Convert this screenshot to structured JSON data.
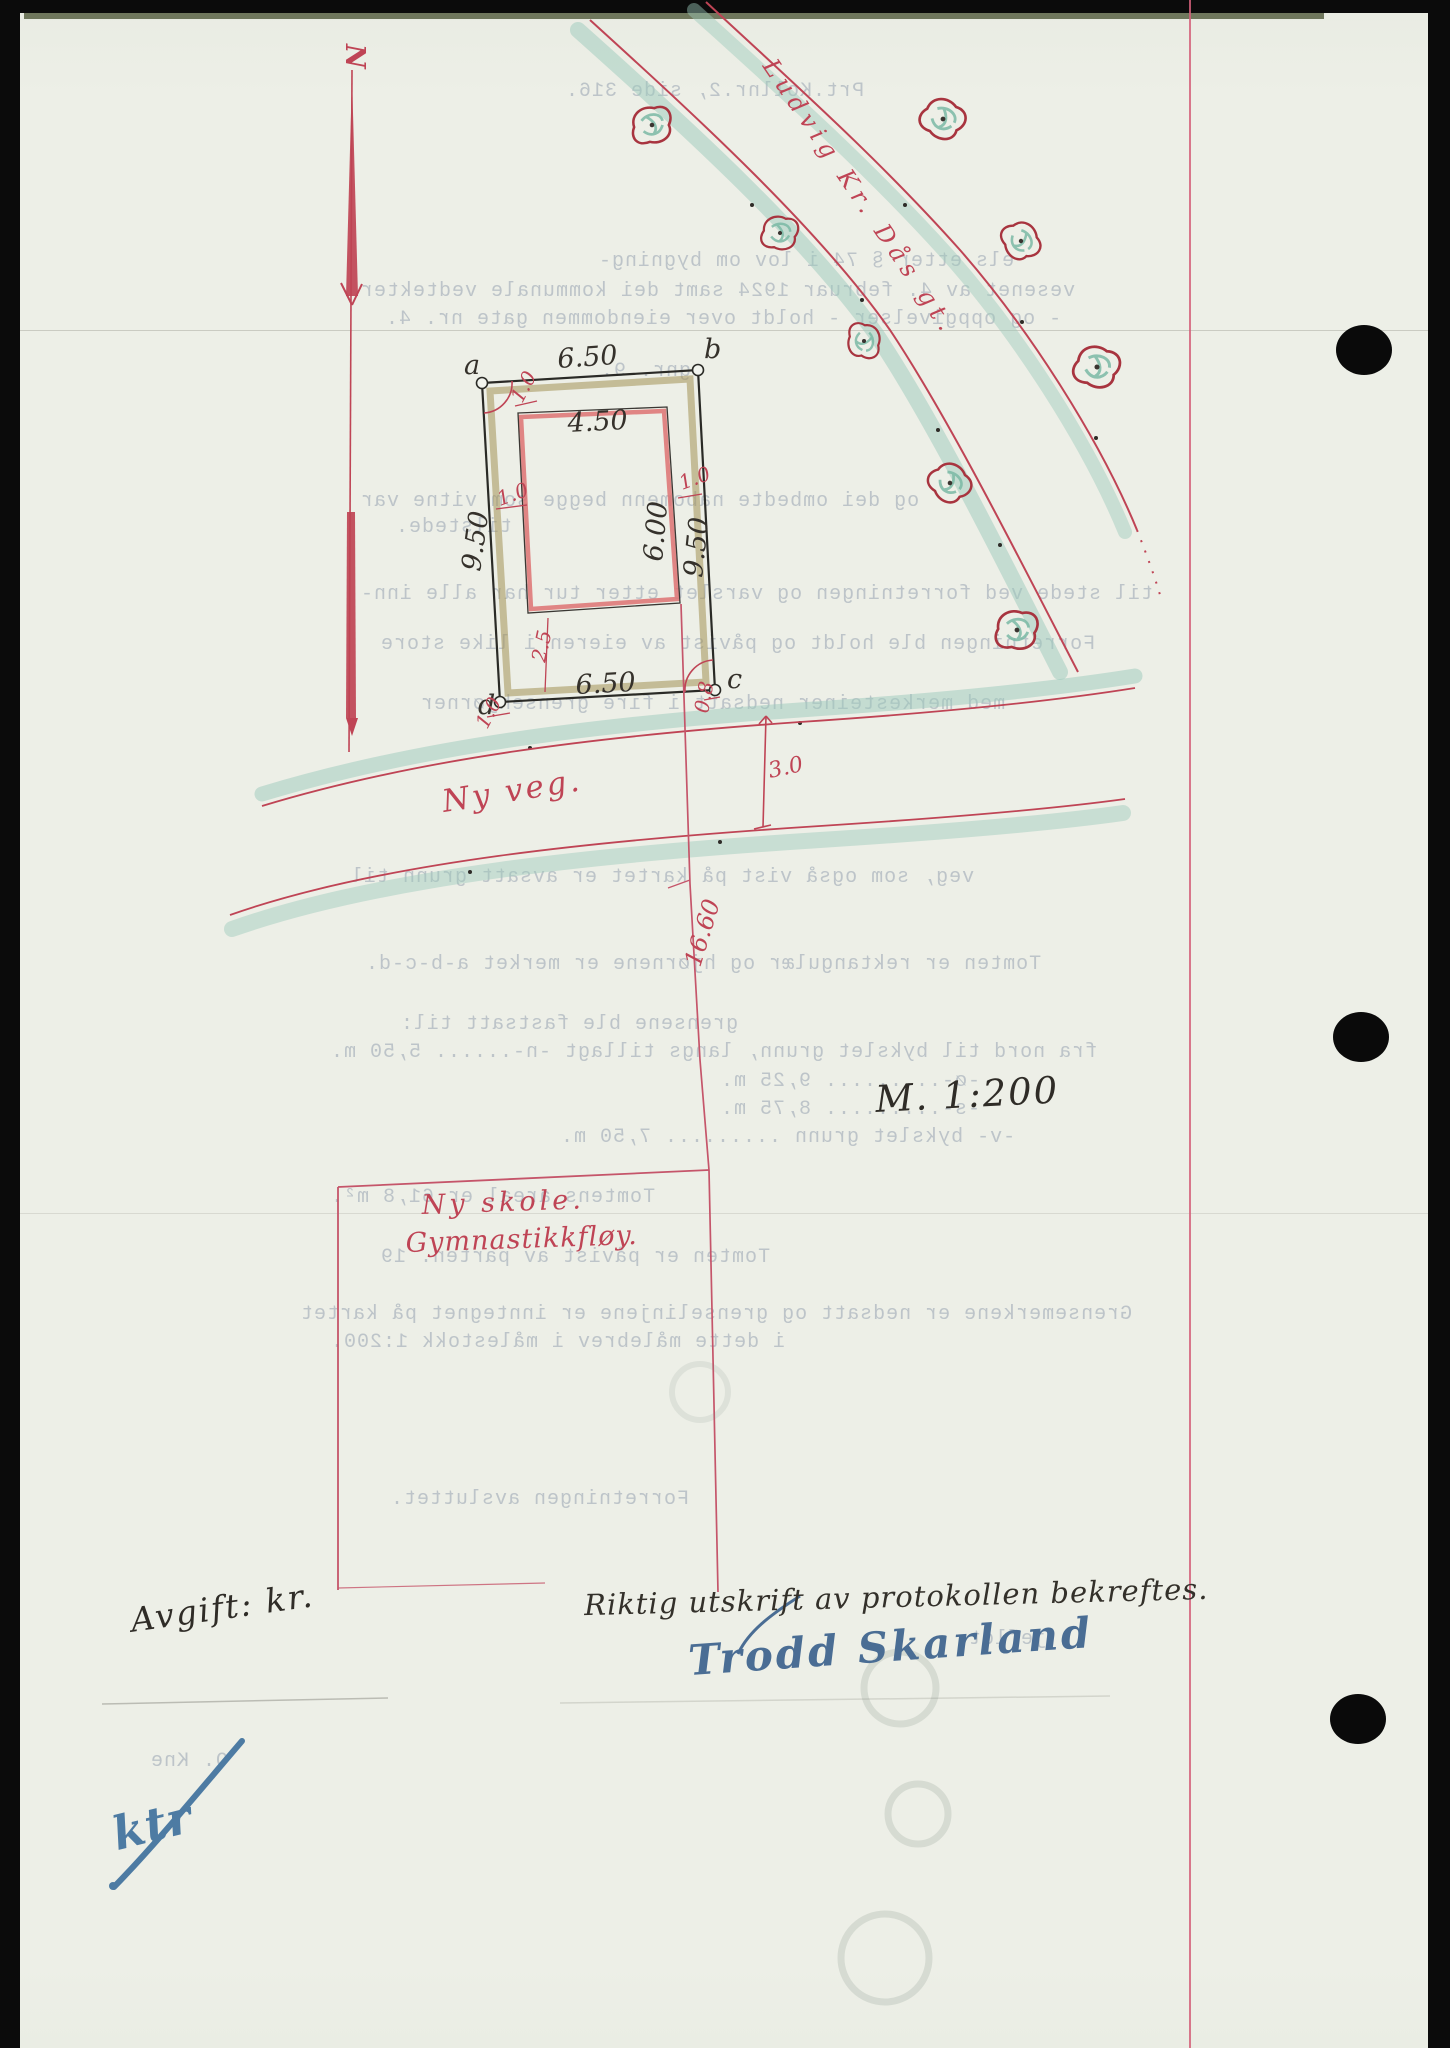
{
  "map": {
    "north_label": "N",
    "street_name": "Ludvig Kr. Dås gt.",
    "road_label": "Ny veg.",
    "school_line1": "Ny skole.",
    "school_line2": "Gymnastikkfløy.",
    "scale_label": "M. 1:200",
    "corners": {
      "a": "a",
      "b": "b",
      "c": "c",
      "d": "d"
    },
    "dims": {
      "top": "6.50",
      "bottom": "6.50",
      "left": "9.50",
      "right": "9.50",
      "inner_top": "4.50",
      "inner_right": "6.00",
      "bottom_gap": "2.5",
      "off_tl": "1.0",
      "off_left": "1.0",
      "off_right": "1.0",
      "off_bl": "1.0",
      "off_c": "0.8",
      "road_width": "3.0",
      "distance_line": "16.60"
    }
  },
  "footer": {
    "fee_label": "Avgift: kr.",
    "certification": "Riktig utskrift av protokollen bekreftes.",
    "signature": "Trodd Skarland",
    "clerk_initials": "ktr"
  },
  "bleedthrough": [
    "Prt.Kollnr.2, side 316.",
    "els etter § 74 i lov om bygning-",
    "vesenet av 4. februar 1924 samt dei kommunale vedtekter",
    "- og oppgivelser - holdt over eiendommen gate nr. 4.",
    "gnr. 9.",
    "og dei ombedte nabomenn begge som vitne var",
    "tilstede.",
    "til stede ved forretningen og varslet etter tur har alle inn-",
    "Forretningen ble holdt og påvist av eieren i like store",
    "med merkesteiner nedsatt i fire grensehjørner",
    "veg, som også vist på kartet er avsatt grunn til",
    "Tomten er rektangulær og hjørnene er merket a-b-c-d.",
    "grensene ble fastsatt til:",
    "fra nord til bykslet grunn, langs tillagt -n-...... 5,50 m.",
    "-ø-......... 9,25 m.",
    "-s-......... 8,75 m.",
    "-v- bykslet grunn ......... 7,50 m.",
    "Tomtens areal er 61,8 m².",
    "Tomten er påvist av parten. 19",
    "Grensemerkene er nedsatt og grenselinjene er inntegnet på kartet",
    "i dette målebrev i målestokk 1:200.",
    "Forretningen avsluttet.",
    "jeflot.",
    "O. Kne"
  ],
  "colors": {
    "red_ink": "#bf4455",
    "green_shade": "#9ccabb",
    "tan_band": "#a39156",
    "blue_ink": "#4a6d94",
    "black_ink": "#322f2b",
    "paper": "#edefe7",
    "margin_red": "#d4607a"
  }
}
